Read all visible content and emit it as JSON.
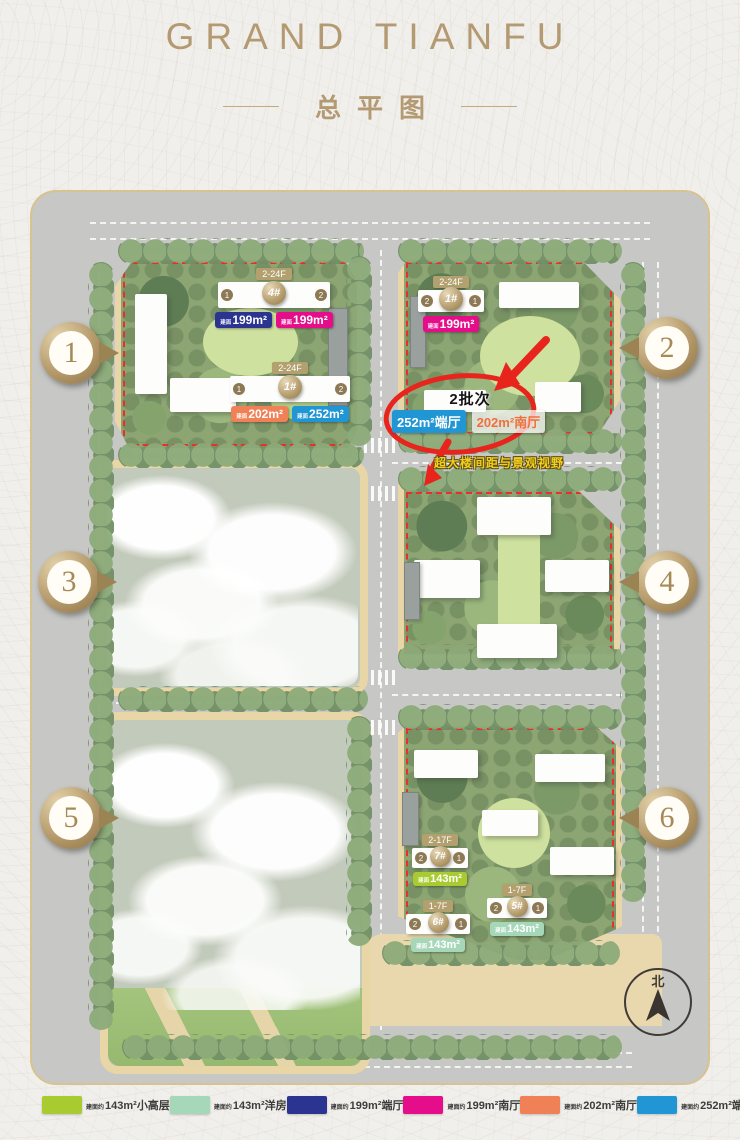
{
  "header": {
    "title": "GRAND TIANFU",
    "subtitle": "总平图"
  },
  "map": {
    "markers": [
      "1",
      "2",
      "3",
      "4",
      "5",
      "6"
    ],
    "north_label": "北",
    "area_prefix": "建面",
    "buildings": [
      {
        "floors": "2-24F",
        "name": "4#",
        "unit_left": "1",
        "unit_right": "2",
        "badges": [
          {
            "text": "199m²",
            "bg": "#2b3490",
            "fg": "#ffffff"
          },
          {
            "text": "199m²",
            "bg": "#e60d8a",
            "fg": "#ffffff"
          }
        ]
      },
      {
        "floors": "2-24F",
        "name": "1#",
        "unit_left": "1",
        "unit_right": "2",
        "badges": [
          {
            "text": "202m²",
            "bg": "#f08055",
            "fg": "#ffffff"
          },
          {
            "text": "252m²",
            "bg": "#2196d4",
            "fg": "#ffffff"
          }
        ]
      },
      {
        "floors": "2-24F",
        "name": "1#",
        "unit_left": "2",
        "unit_right": "1",
        "badges": [
          {
            "text": "199m²",
            "bg": "#e60d8a",
            "fg": "#ffffff"
          }
        ]
      },
      {
        "floors": "2-17F",
        "name": "7#",
        "unit_left": "2",
        "unit_right": "1",
        "badges": [
          {
            "text": "143m²",
            "bg": "#a8cb2f",
            "fg": "#ffffff"
          }
        ]
      },
      {
        "floors": "1-7F",
        "name": "6#",
        "unit_left": "2",
        "unit_right": "1",
        "badges": [
          {
            "text": "143m²",
            "bg": "#a7d7b9",
            "fg": "#ffffff"
          }
        ]
      },
      {
        "floors": "1-7F",
        "name": "5#",
        "unit_left": "2",
        "unit_right": "1",
        "badges": [
          {
            "text": "143m²",
            "bg": "#a7d7b9",
            "fg": "#ffffff"
          }
        ]
      }
    ],
    "annotation": {
      "batch_label": "2批次",
      "badge_blue": {
        "text": "252m²端厅",
        "bg": "#2196d4",
        "fg": "#ffffff"
      },
      "badge_orange": {
        "text": "202m²南厅",
        "bg": "rgba(255,255,255,0.72)",
        "fg": "#f0703d"
      },
      "view_note": "超大楼间距与景观视野"
    }
  },
  "legend": {
    "prefix": "建面约",
    "items": [
      {
        "label": "143m²小高层",
        "color": "#a8cb2f"
      },
      {
        "label": "143m²洋房",
        "color": "#a7d7b9"
      },
      {
        "label": "199m²端厅",
        "color": "#2b3490"
      },
      {
        "label": "199m²南厅",
        "color": "#e60d8a"
      },
      {
        "label": "202m²南厅",
        "color": "#f08055"
      },
      {
        "label": "252m²端厅",
        "color": "#2196d4"
      }
    ]
  },
  "colors": {
    "gold": "#b49a72",
    "red": "#e8251d"
  }
}
